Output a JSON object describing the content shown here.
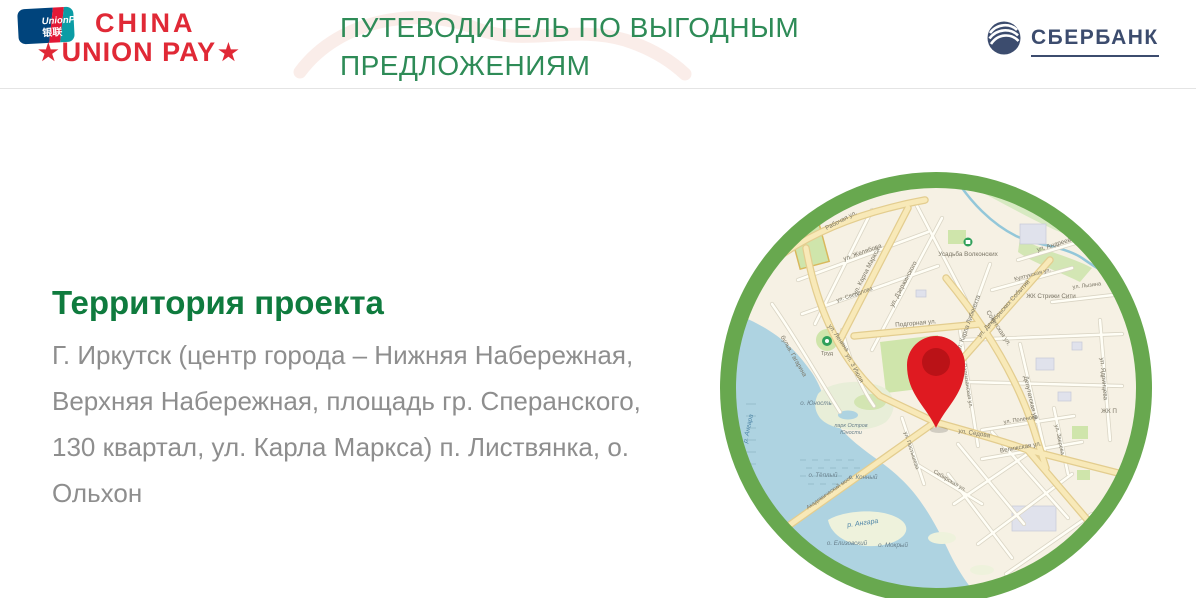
{
  "header": {
    "unionpay_card": {
      "line1": "UnionPay",
      "line2": "银联"
    },
    "unionpay_brand": {
      "line1": "CHINA",
      "line2": "UNION PAY",
      "star": "★"
    },
    "title": {
      "line1": "ПУТЕВОДИТЕЛЬ ПО ВЫГОДНЫМ",
      "line2": "ПРЕДЛОЖЕНИЯМ"
    },
    "sberbank": {
      "name": "СБЕРБАНК"
    }
  },
  "content": {
    "heading": "Территория проекта",
    "body_lines": [
      "Г. Иркутск (центр города – Нижняя Набережная,",
      "Верхняя Набережная, площадь гр. Сперанского,",
      "130 квартал, ул. Карла Маркса) п. Листвянка, о.",
      "Ольхон"
    ]
  },
  "map": {
    "labels": {
      "rabochaya": "Рабочая ул.",
      "zhelyabova": "ул. Желябова",
      "sverdlova": "ул. Свердлова",
      "karla_marksa": "ул. Карла Маркса",
      "dzerzhinskogo": "ул. Дзержинского",
      "usadba": "Усадьба Волконских",
      "dekabrskikh": "ул. Декабрьских Событий",
      "libknekhta": "ул. Карла Либкнехта",
      "andreeva": "ул. Андреева",
      "kultukskaya": "Култукская ул.",
      "zhk_strizhi": "ЖК Стрижи Сити",
      "lyzina": "ул. Лызина",
      "sovetskaya": "Советская ул.",
      "podgornaya": "Подгорная ул.",
      "lenina": "ул. Ленина",
      "gagarina": "бульв. Гагарина",
      "trud": "Труд",
      "iyulya": "ул. 3 Июля",
      "yunost": "о. Юность",
      "park1": "парк Остров",
      "park2": "Юности",
      "teply": "о. Тёплый",
      "konny": "о. Конный",
      "angara1": "р. Ангара",
      "angara2": "р. Ангара",
      "elizovsky": "о. Елизовский",
      "mokry": "о. Мокрый",
      "sedova": "ул. Седова",
      "partizanskaya": "Партизанская ул.",
      "deputatskaya": "Депутатская ул.",
      "yadrintseva": "ул. Ядринцева",
      "zhk_parus": "ЖК П",
      "postysheva": "ул. Постышева",
      "sibirskaya": "Сибирская ул.",
      "polenova": "ул. Поленова",
      "velizhskaya": "Велижская ул.",
      "zvereva": "ул. Зверева",
      "most": "Академический мост"
    }
  },
  "colors": {
    "title_green": "#2e8b57",
    "heading_green": "#0f7b3e",
    "body_gray": "#8e8e8e",
    "brand_red": "#e02936",
    "sber_navy": "#3c4c6e",
    "ring_green": "#68a84f",
    "map_land": "#f6f1e4",
    "map_water": "#aed3e1",
    "road_yellow": "#f8e9b8",
    "park_green": "#cfe5ab",
    "pin_red": "#df1a21"
  }
}
